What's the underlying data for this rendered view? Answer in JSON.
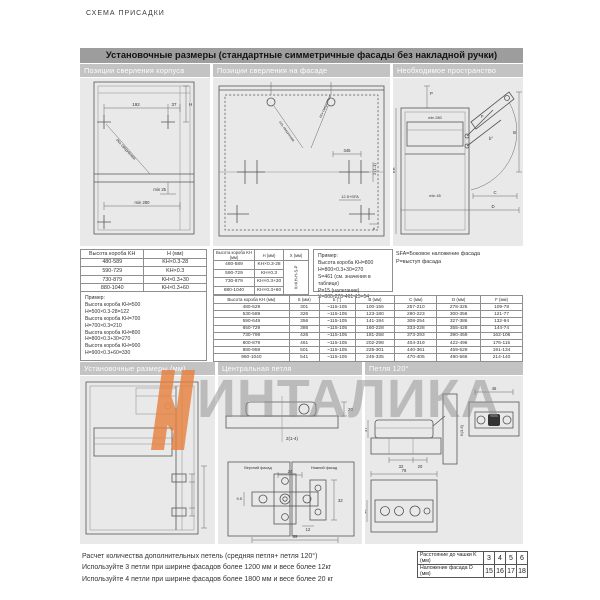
{
  "page": {
    "kicker": "СХЕМА ПРИСАДКИ"
  },
  "watermark": {
    "text": "ИНТАЛИКА",
    "accent_color": "#e87f3d"
  },
  "top": {
    "title": "Установочные размеры (стандартные симметричные фасады без накладной ручки)",
    "columns": [
      "Позиции сверления корпуса",
      "Позиции сверления на фасаде",
      "Необходимое пространство"
    ],
    "corpus": {
      "d192": "192",
      "d37": "37",
      "dH": "H",
      "dmin25": "min 25",
      "dmin280": "min 280",
      "axis": "ось сверления"
    },
    "facade": {
      "d345": "345",
      "d214": "2 (1-4)",
      "dsfa": "12.5+SFA",
      "d6": "6",
      "axis_l": "ось сверления",
      "axis_r": "ось сверления"
    },
    "space": {
      "dP": "P",
      "dB": "B",
      "dC": "C",
      "dD": "D",
      "dF": "F",
      "dAngle": "b°",
      "dKH": "KH",
      "dmin280": "min 280",
      "dmin45": "min 45"
    },
    "notes": [
      "SFA=Боковое наложение фасада",
      "P=выступ фасада"
    ],
    "tableH": {
      "headers": [
        "Высота короба KH",
        "H (мм)"
      ],
      "rows": [
        [
          "480-589",
          "KH×0.3-28"
        ],
        [
          "590-729",
          "KH×0.3"
        ],
        [
          "730-879",
          "KH×0.3+30"
        ],
        [
          "880-1040",
          "KH×0.3+60"
        ]
      ],
      "example_title": "Пример:",
      "example": [
        "Высота короба KH=500",
        "H=500×0.3-28=122",
        "Высота короба KH=700",
        "H=700×0.3=210",
        "Высота короба KH=800",
        "H=800×0.3+30=270",
        "Высота короба KH=900",
        "H=900×0.3+60=330"
      ]
    },
    "tableHX": {
      "headers": [
        "Высота короба KH (мм)",
        "H (мм)",
        "X (мм)"
      ],
      "rows": [
        [
          "480-589",
          "KH×0.3-28"
        ],
        [
          "590-729",
          "KH×0.3"
        ],
        [
          "730-879",
          "KH×0.3+30"
        ],
        [
          "880-1040",
          "KH×0.3+60"
        ]
      ],
      "x_formula": "X=KH-H-S-P",
      "example_title": "Пример:",
      "example": [
        "Высота короба KH=800",
        "H=800×0.3+30=270",
        "S=461 (см. значения в таблице)",
        "P=15 (налегание)",
        "X=800-270-461-15=54"
      ]
    },
    "tableS": {
      "headers": [
        "Высота короба KH (мм)",
        "S (мм)",
        "b (°)",
        "B (мм)",
        "C (мм)",
        "D (мм)",
        "F (мм)"
      ],
      "rows": [
        [
          "480-529",
          "301",
          "~115-105",
          "100-156",
          "257-210",
          "278-325",
          "109-78"
        ],
        [
          "530-589",
          "326",
          "~115-105",
          "123-180",
          "290-223",
          "300-356",
          "121-77"
        ],
        [
          "590-649",
          "356",
          "~115-105",
          "141-194",
          "308-254",
          "327-386",
          "132-94"
        ],
        [
          "650-729",
          "386",
          "~115-105",
          "160-228",
          "333-228",
          "355-428",
          "144-74"
        ],
        [
          "730-799",
          "426",
          "~115-105",
          "181-258",
          "373-293",
          "390-459",
          "162-106"
        ],
        [
          "800-879",
          "461",
          "~115-105",
          "202-298",
          "404-319",
          "422-496",
          "176-115"
        ],
        [
          "880-959",
          "501",
          "~115-105",
          "225-301",
          "440-361",
          "459-529",
          "191-134"
        ],
        [
          "960-1040",
          "541",
          "~115-105",
          "245-335",
          "470-405",
          "490-566",
          "214-140"
        ]
      ]
    }
  },
  "bottom": {
    "columns": [
      "Установочные размеры (мм)",
      "Центральная петля",
      "Петля 120°"
    ],
    "central": {
      "d20": "20",
      "d214": "2(1-4)",
      "upper": "Верхний фасад",
      "lower": "Нижний фасад",
      "d24": "24",
      "d95": "9.5",
      "d32": "32",
      "d12": "12",
      "d89": "89"
    },
    "hinge120": {
      "d45": "45",
      "d37": "37",
      "d32": "32",
      "d20": "20",
      "d76": "76",
      "d15": "15",
      "dK": "K(3-6)"
    }
  },
  "footer": {
    "lines": [
      "Расчет  количества дополнительных петель (средняя петля+ петля 120°)",
      "Используйте 3 петли при ширине фасадов более 1200 мм и весе более 12кг",
      "Используйте 4 петли при ширине фасадов более 1800 мм и весе более 20 кг"
    ],
    "table": {
      "row1_label": "Расстояние до чашки K (мм)",
      "row1_values": [
        "3",
        "4",
        "5",
        "6"
      ],
      "row2_label": "Наложение фасада D (мм)",
      "row2_values": [
        "15",
        "16",
        "17",
        "18"
      ]
    }
  }
}
